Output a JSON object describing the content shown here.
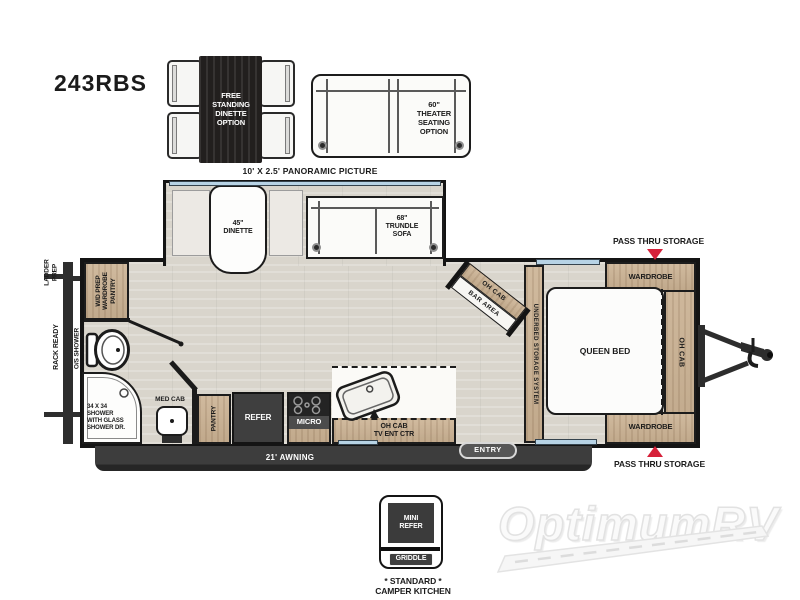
{
  "title": "243RBS",
  "watermark": "OptimumRV",
  "colors": {
    "accent_red": "#d62039",
    "wood": "#cbb293",
    "floor": "#d9d5cc",
    "dark_gray": "#3f3f3f",
    "window_blue": "#b7d3e5",
    "outline": "#141414"
  },
  "options": {
    "dinette_label": "FREE\nSTANDING\nDINETTE\nOPTION",
    "theater_label": "60\"\nTHEATER\nSEATING\nOPTION"
  },
  "exterior": {
    "panoramic": "10' X 2.5' PANORAMIC PICTURE",
    "ladder_prep": "LADDER\nPREP",
    "rack_ready": "RACK READY",
    "os_shower": "O/S SHOWER",
    "awning": "21' AWNING",
    "entry": "ENTRY",
    "pass_thru_top": "PASS THRU STORAGE",
    "pass_thru_bottom": "PASS THRU STORAGE"
  },
  "interior": {
    "dinette": "45\"\nDINETTE",
    "trundle_sofa": "68\"\nTRUNDLE\nSOFA",
    "wd_prep": "W/D PREP\nWARDROBE\nPANTRY",
    "shower": "34 X 34\nSHOWER\nWITH GLASS\nSHOWER DR.",
    "med_cab": "MED CAB",
    "pantry": "PANTRY",
    "refer": "REFER",
    "micro": "MICRO",
    "oh_cab_tv": "OH CAB\nTV ENT CTR",
    "oh_cab_corner": "OH CAB",
    "bar_area": "BAR AREA",
    "underbed": "UNDERBED STORAGE SYSTEM",
    "queen_bed": "QUEEN BED",
    "wardrobe_top": "WARDROBE",
    "wardrobe_bottom": "WARDROBE",
    "oh_cab_front": "OH CAB"
  },
  "camper_kitchen": {
    "mini_refer": "MINI\nREFER",
    "griddle": "GRIDDLE",
    "caption": "* STANDARD *\nCAMPER KITCHEN"
  }
}
